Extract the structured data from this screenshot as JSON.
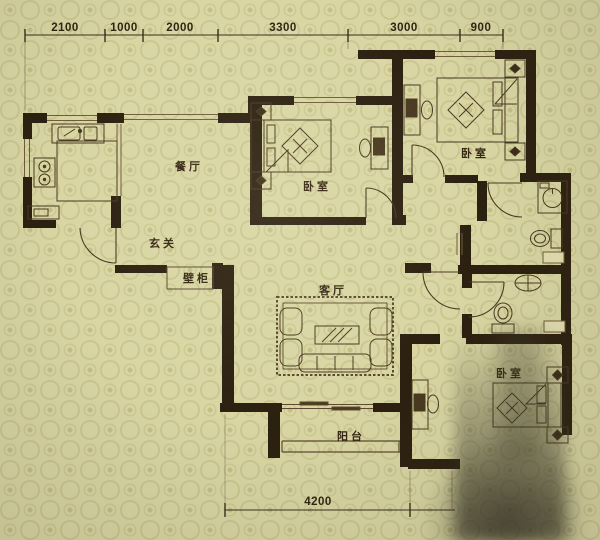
{
  "canvas": {
    "width": 600,
    "height": 540,
    "type": "apartment-floor-plan"
  },
  "colors": {
    "background": "#d9d6a4",
    "pattern_motif": "#c3bf86",
    "wall": "#2c2010",
    "furniture_line": "#4a3921",
    "window_line": "#6f5c3c",
    "label_text": "#352513",
    "dimension_text": "#2f2414"
  },
  "dims": {
    "top": [
      "2100",
      "1000",
      "2000",
      "3300",
      "3000",
      "900"
    ],
    "bottom": [
      "4200"
    ]
  },
  "rooms": [
    {
      "id": "dining-room",
      "label": "餐厅"
    },
    {
      "id": "foyer",
      "label": "玄关"
    },
    {
      "id": "wall-closet",
      "label": "壁柜"
    },
    {
      "id": "bedroom-middle",
      "label": "卧室"
    },
    {
      "id": "bedroom-top-right",
      "label": "卧室"
    },
    {
      "id": "living-room",
      "label": "客厅"
    },
    {
      "id": "balcony",
      "label": "阳台"
    },
    {
      "id": "bedroom-bottom-right",
      "label": "卧室"
    }
  ],
  "fixtures": [
    "kitchen-sink",
    "stove",
    "kitchen-counter",
    "base-cabinet",
    "double-bed",
    "nightstand",
    "pillow",
    "quilt-decor",
    "desk",
    "desk-chair",
    "washing-machine",
    "toilet",
    "washbasin",
    "rug",
    "sofa",
    "armchair",
    "coffee-table",
    "balcony-railing",
    "sliding-door",
    "door-swing",
    "window"
  ]
}
